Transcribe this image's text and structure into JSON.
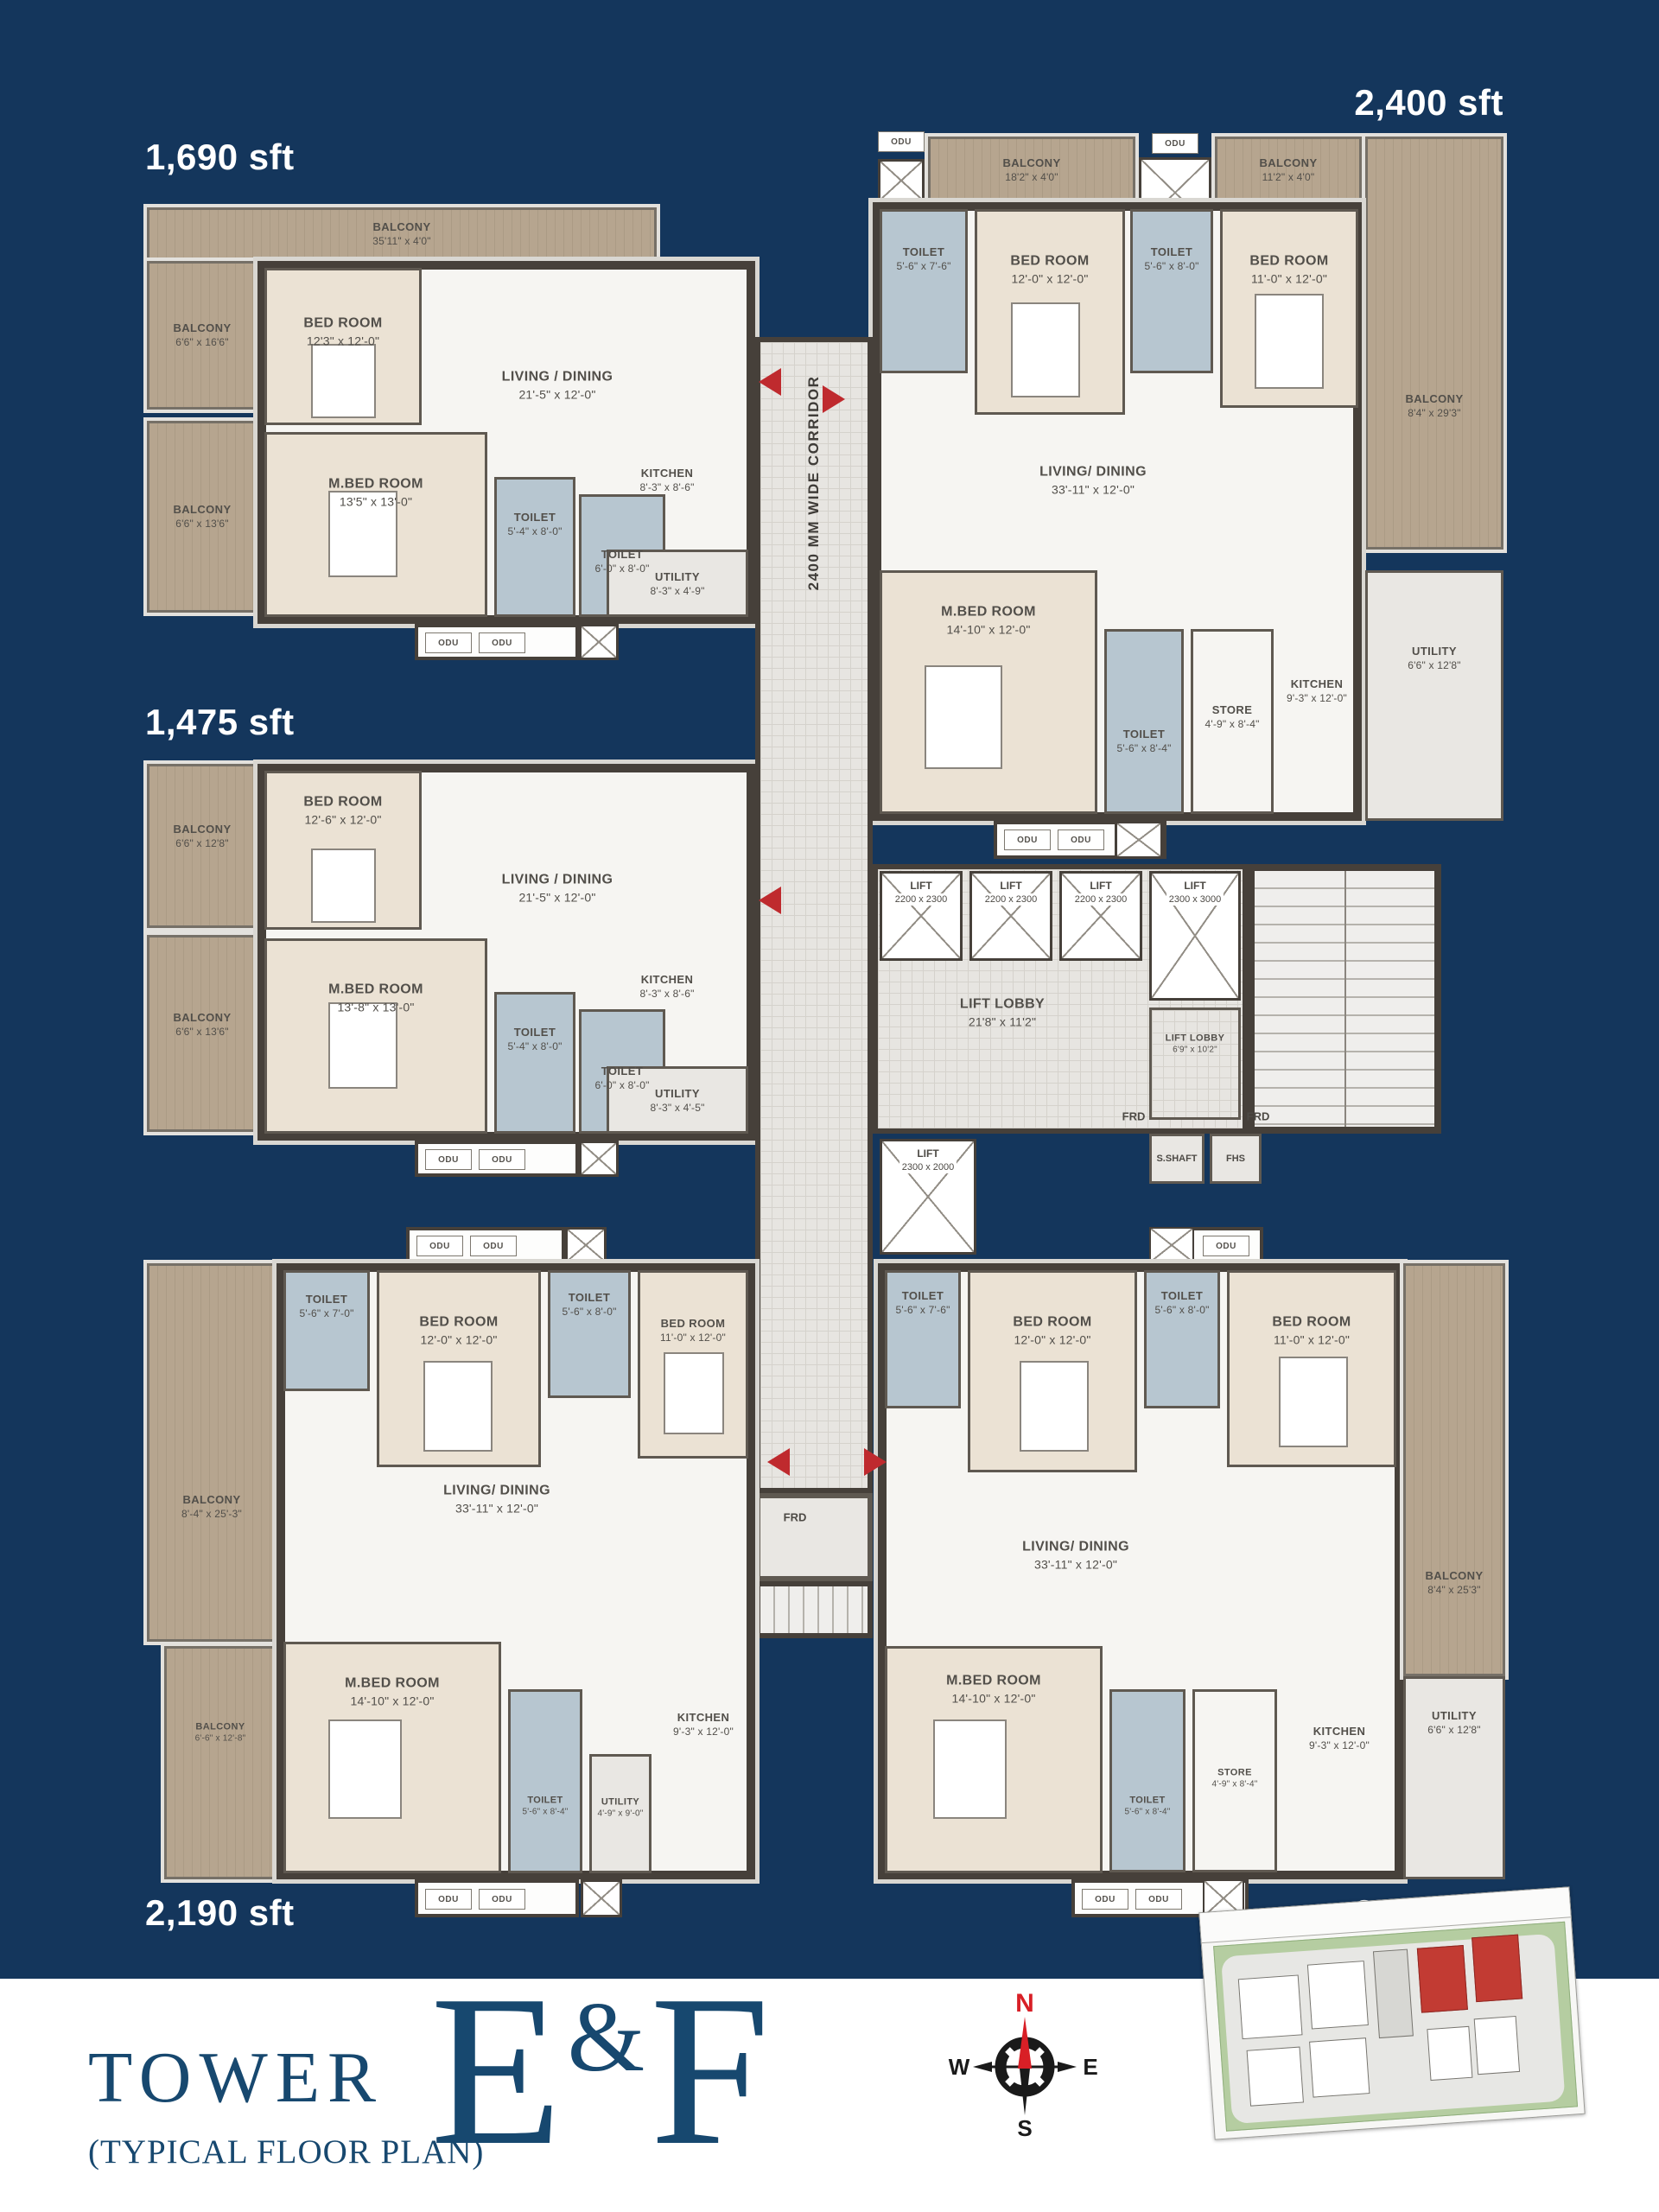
{
  "title": {
    "tower": "TOWER",
    "subtitle": "(TYPICAL FLOOR PLAN)",
    "block_e": "E",
    "ampersand": "&",
    "block_f": "F"
  },
  "compass": {
    "n": "N",
    "e": "E",
    "s": "S",
    "w": "W"
  },
  "corridor_label": "2400 MM WIDE CORRIDOR",
  "odu_label": "ODU",
  "core": {
    "lifts": [
      {
        "name": "LIFT",
        "dim": "2200 x 2300"
      },
      {
        "name": "LIFT",
        "dim": "2200 x 2300"
      },
      {
        "name": "LIFT",
        "dim": "2200 x 2300"
      },
      {
        "name": "LIFT",
        "dim": "2300 x 3000"
      },
      {
        "name": "LIFT",
        "dim": "2300 x 2000"
      }
    ],
    "lobby": {
      "name": "LIFT LOBBY",
      "dim": "21'8\" x 11'2\""
    },
    "lobby_small": {
      "name": "LIFT LOBBY",
      "dim": "6'9\" x 10'2\""
    },
    "frd": "FRD",
    "s_shaft": "S.SHAFT",
    "fhs": "FHS"
  },
  "apt_1690": {
    "area": "1,690 sft",
    "balcony_top": {
      "name": "BALCONY",
      "dim": "35'11\" x 4'0\""
    },
    "balcony_left_upper": {
      "name": "BALCONY",
      "dim": "6'6\" x 16'6\""
    },
    "balcony_left_lower": {
      "name": "BALCONY",
      "dim": "6'6\" x 13'6\""
    },
    "bedroom": {
      "name": "BED ROOM",
      "dim": "12'3\" x 12'-0\""
    },
    "living": {
      "name": "LIVING / DINING",
      "dim": "21'-5\" x 12'-0\""
    },
    "master_bedroom": {
      "name": "M.BED ROOM",
      "dim": "13'5\" x 13'-0\""
    },
    "toilet_1": {
      "name": "TOILET",
      "dim": "5'-4\" x 8'-0\""
    },
    "toilet_2": {
      "name": "TOILET",
      "dim": "6'-0\" x 8'-0\""
    },
    "kitchen": {
      "name": "KITCHEN",
      "dim": "8'-3\" x 8'-6\""
    },
    "utility": {
      "name": "UTILITY",
      "dim": "8'-3\" x 4'-9\""
    }
  },
  "apt_2400": {
    "area": "2,400 sft",
    "balcony_top_left": {
      "name": "BALCONY",
      "dim": "18'2\" x 4'0\""
    },
    "balcony_top_right": {
      "name": "BALCONY",
      "dim": "11'2\" x 4'0\""
    },
    "balcony_right": {
      "name": "BALCONY",
      "dim": "8'4\" x 29'3\""
    },
    "toilet_1": {
      "name": "TOILET",
      "dim": "5'-6\" x 7'-6\""
    },
    "bedroom_1": {
      "name": "BED ROOM",
      "dim": "12'-0\" x 12'-0\""
    },
    "toilet_2": {
      "name": "TOILET",
      "dim": "5'-6\" x 8'-0\""
    },
    "bedroom_2": {
      "name": "BED ROOM",
      "dim": "11'-0\" x 12'-0\""
    },
    "living": {
      "name": "LIVING/ DINING",
      "dim": "33'-11\" x 12'-0\""
    },
    "master_bedroom": {
      "name": "M.BED ROOM",
      "dim": "14'-10\" x 12'-0\""
    },
    "toilet_3": {
      "name": "TOILET",
      "dim": "5'-6\" x 8'-4\""
    },
    "store": {
      "name": "STORE",
      "dim": "4'-9\" x 8'-4\""
    },
    "kitchen": {
      "name": "KITCHEN",
      "dim": "9'-3\" x 12'-0\""
    },
    "utility": {
      "name": "UTILITY",
      "dim": "6'6\" x 12'8\""
    }
  },
  "apt_1475": {
    "area": "1,475 sft",
    "balcony_left_upper": {
      "name": "BALCONY",
      "dim": "6'6\" x 12'8\""
    },
    "balcony_left_lower": {
      "name": "BALCONY",
      "dim": "6'6\" x 13'6\""
    },
    "bedroom": {
      "name": "BED ROOM",
      "dim": "12'-6\" x 12'-0\""
    },
    "master_bedroom": {
      "name": "M.BED ROOM",
      "dim": "13'-8\" x 13'-0\""
    },
    "living": {
      "name": "LIVING / DINING",
      "dim": "21'-5\" x 12'-0\""
    },
    "toilet_1": {
      "name": "TOILET",
      "dim": "5'-4\" x 8'-0\""
    },
    "toilet_2": {
      "name": "TOILET",
      "dim": "6'-0\" x 8'-0\""
    },
    "kitchen": {
      "name": "KITCHEN",
      "dim": "8'-3\" x 8'-6\""
    },
    "utility": {
      "name": "UTILITY",
      "dim": "8'-3\" x 4'-5\""
    }
  },
  "apt_2190_left": {
    "area": "2,190 sft",
    "balcony_left": {
      "name": "BALCONY",
      "dim": "8'-4\" x 25'-3\""
    },
    "balcony_left_lower": {
      "name": "BALCONY",
      "dim": "6'-6\" x 12'-8\""
    },
    "toilet_1": {
      "name": "TOILET",
      "dim": "5'-6\" x 7'-0\""
    },
    "bedroom_1": {
      "name": "BED ROOM",
      "dim": "12'-0\" x 12'-0\""
    },
    "toilet_2": {
      "name": "TOILET",
      "dim": "5'-6\" x 8'-0\""
    },
    "bedroom_2": {
      "name": "BED ROOM",
      "dim": "11'-0\" x 12'-0\""
    },
    "living": {
      "name": "LIVING/ DINING",
      "dim": "33'-11\" x 12'-0\""
    },
    "master_bedroom": {
      "name": "M.BED ROOM",
      "dim": "14'-10\" x 12'-0\""
    },
    "toilet_3": {
      "name": "TOILET",
      "dim": "5'-6\" x 8'-4\""
    },
    "utility": {
      "name": "UTILITY",
      "dim": "4'-9\" x 9'-0\""
    },
    "kitchen": {
      "name": "KITCHEN",
      "dim": "9'-3\" x 12'-0\""
    }
  },
  "apt_2190_right": {
    "area": "2,190 sft",
    "toilet_1": {
      "name": "TOILET",
      "dim": "5'-6\" x 7'-6\""
    },
    "bedroom_1": {
      "name": "BED ROOM",
      "dim": "12'-0\" x 12'-0\""
    },
    "toilet_2": {
      "name": "TOILET",
      "dim": "5'-6\" x 8'-0\""
    },
    "bedroom_2": {
      "name": "BED ROOM",
      "dim": "11'-0\" x 12'-0\""
    },
    "living": {
      "name": "LIVING/ DINING",
      "dim": "33'-11\" x 12'-0\""
    },
    "balcony_right": {
      "name": "BALCONY",
      "dim": "8'4\" x 25'3\""
    },
    "master_bedroom": {
      "name": "M.BED ROOM",
      "dim": "14'-10\" x 12'-0\""
    },
    "toilet_3": {
      "name": "TOILET",
      "dim": "5'-6\" x 8'-4\""
    },
    "store": {
      "name": "STORE",
      "dim": "4'-9\" x 8'-4\""
    },
    "kitchen": {
      "name": "KITCHEN",
      "dim": "9'-3\" x 12'-0\""
    },
    "utility": {
      "name": "UTILITY",
      "dim": "6'6\" x 12'8\""
    }
  },
  "colors": {
    "background": "#14365C",
    "accent_red": "#BF2A2E",
    "title": "#17486F",
    "wall": "#46403A"
  }
}
